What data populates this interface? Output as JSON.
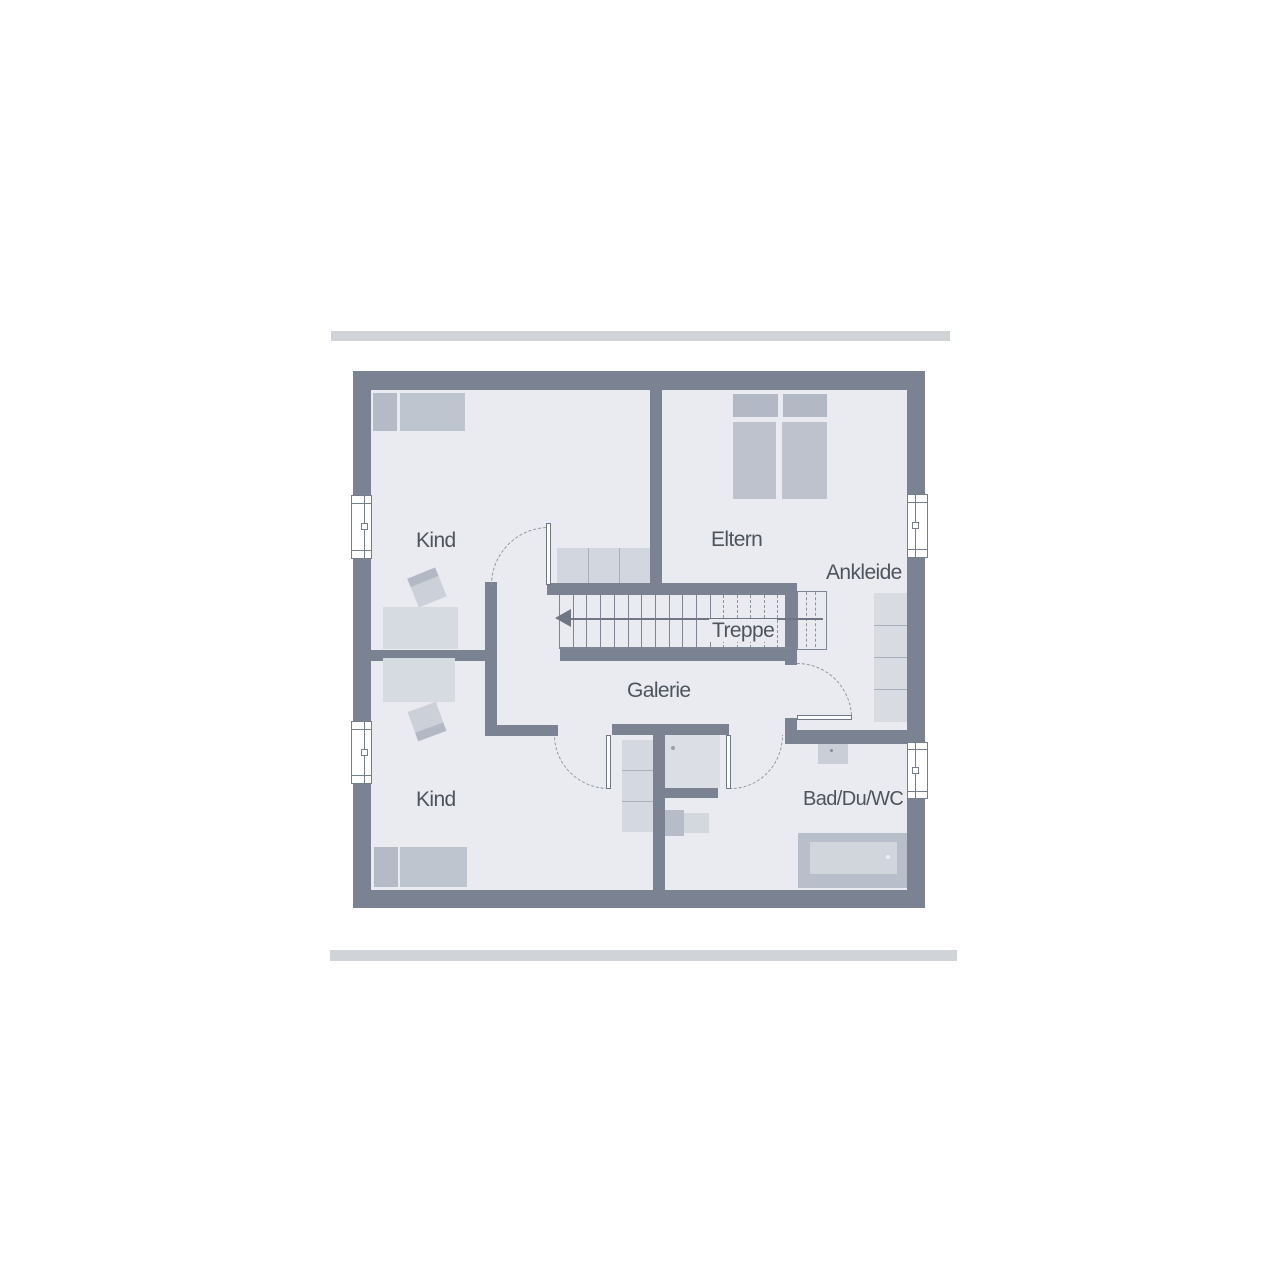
{
  "rooms": {
    "kind_top": "Kind",
    "eltern": "Eltern",
    "ankleide": "Ankleide",
    "treppe": "Treppe",
    "galerie": "Galerie",
    "kind_bottom": "Kind",
    "bad": "Bad/Du/WC"
  },
  "colors": {
    "wall": "#7b8392",
    "floor": "#e9ebf0",
    "bar": "#d0d3d8",
    "furniture_dark": "#b6bcc8",
    "furniture_light": "#d6dae1",
    "text": "#4e545e"
  }
}
